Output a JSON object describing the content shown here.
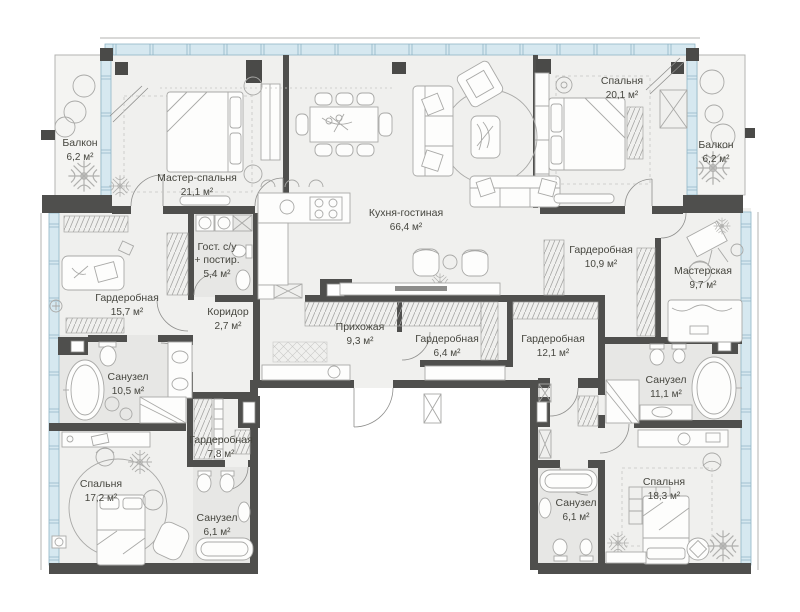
{
  "plan_title": "apartment-floor-plan",
  "colors": {
    "wall": "#4f4f4d",
    "glazing": "#d6e8f0",
    "glazing_frame": "#8fb5c6",
    "room_fill": "#f0f0ee",
    "wet_room_fill": "#e7e7e5",
    "balcony_fill": "#f4f4f2",
    "label_text": "#46463f",
    "furniture_line": "#a9a9a7"
  },
  "rooms": [
    {
      "id": "balcony-left",
      "name": "Балкон",
      "area": "6,2 м²"
    },
    {
      "id": "master-bedroom",
      "name": "Мастер-спальня",
      "area": "21,1 м²"
    },
    {
      "id": "kitchen-living",
      "name": "Кухня-гостиная",
      "area": "66,4 м²"
    },
    {
      "id": "bedroom-top-right",
      "name": "Спальня",
      "area": "20,1 м²"
    },
    {
      "id": "balcony-right",
      "name": "Балкон",
      "area": "6,2 м²"
    },
    {
      "id": "wardrobe-157",
      "name": "Гардеробная",
      "area": "15,7 м²"
    },
    {
      "id": "guest-bath",
      "name": "Гост. с/у",
      "name2": "+ постир.",
      "area": "5,4 м²"
    },
    {
      "id": "corridor",
      "name": "Коридор",
      "area": "2,7 м²"
    },
    {
      "id": "hallway",
      "name": "Прихожая",
      "area": "9,3 м²"
    },
    {
      "id": "wardrobe-64",
      "name": "Гардеробная",
      "area": "6,4 м²"
    },
    {
      "id": "wardrobe-109",
      "name": "Гардеробная",
      "area": "10,9 м²"
    },
    {
      "id": "workshop",
      "name": "Мастерская",
      "area": "9,7 м²"
    },
    {
      "id": "wardrobe-121",
      "name": "Гардеробная",
      "area": "12,1 м²"
    },
    {
      "id": "bathroom-105",
      "name": "Санузел",
      "area": "10,5 м²"
    },
    {
      "id": "bathroom-111",
      "name": "Санузел",
      "area": "11,1 м²"
    },
    {
      "id": "wardrobe-78",
      "name": "Гардеробная",
      "area": "7,8 м²"
    },
    {
      "id": "bedroom-172",
      "name": "Спальня",
      "area": "17,2 м²"
    },
    {
      "id": "bathroom-61-left",
      "name": "Санузел",
      "area": "6,1 м²"
    },
    {
      "id": "bathroom-61-right",
      "name": "Санузел",
      "area": "6,1 м²"
    },
    {
      "id": "bedroom-183",
      "name": "Спальня",
      "area": "18,3 м²"
    }
  ]
}
